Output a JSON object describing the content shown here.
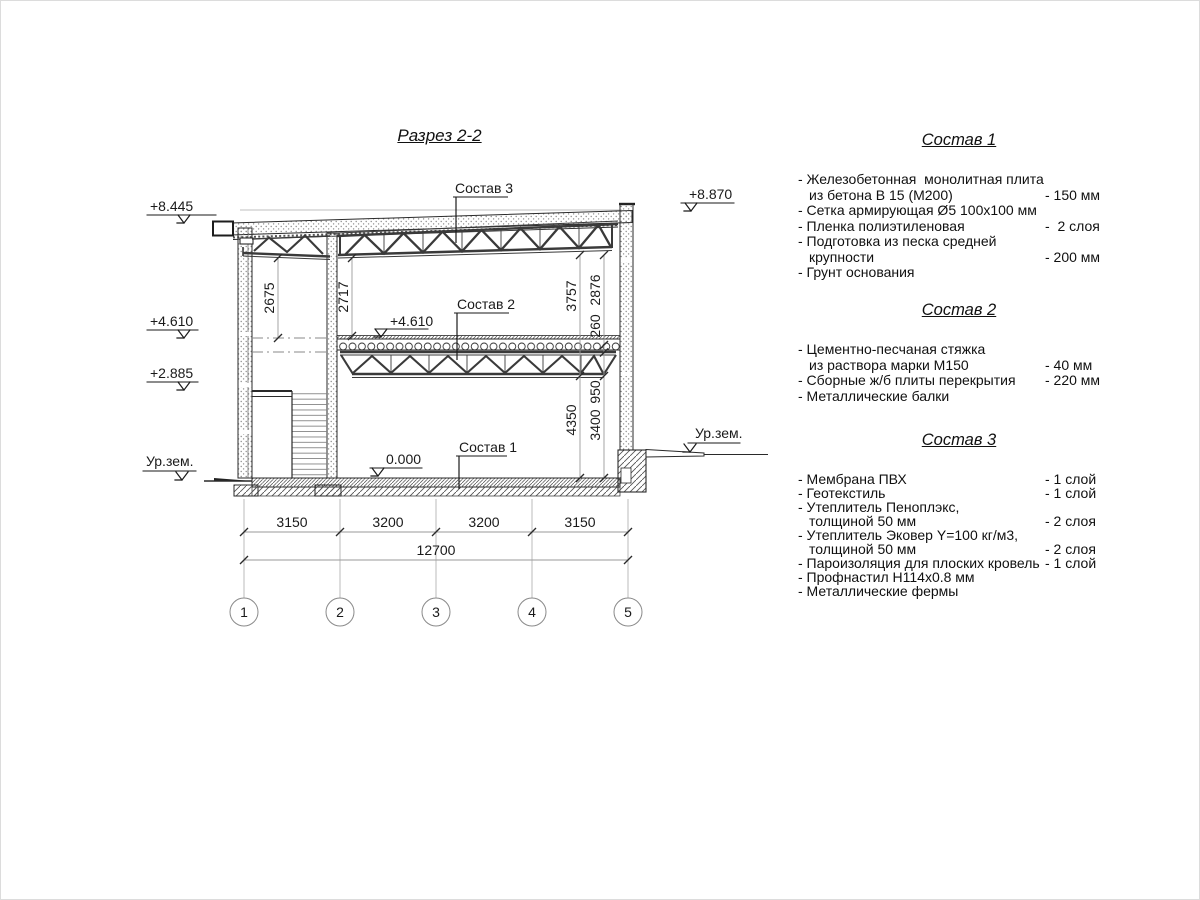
{
  "title": "Разрез 2-2",
  "leaders": {
    "sostav1": "Состав 1",
    "sostav2": "Состав 2",
    "sostav3": "Состав 3"
  },
  "elevations": {
    "roof_left": "+8.445",
    "roof_right": "+8.870",
    "floor2_left": "+4.610",
    "floor2_inner": "+4.610",
    "landing": "+2.885",
    "zero": "0.000",
    "ground_left": "Ур.зем.",
    "ground_right": "Ур.зем."
  },
  "dims": {
    "v2675": "2675",
    "v2717": "2717",
    "v3757": "3757",
    "v2876": "2876",
    "v260": "260",
    "v950": "950",
    "v4350": "4350",
    "v3400": "3400",
    "h1": "3150",
    "h2": "3200",
    "h3": "3200",
    "h4": "3150",
    "total": "12700"
  },
  "axes": [
    "1",
    "2",
    "3",
    "4",
    "5"
  ],
  "compositions": [
    {
      "title": "Состав 1",
      "items": [
        {
          "text": "- Железобетонная  монолитная плита",
          "value": ""
        },
        {
          "text": "из бетона В 15 (М200)",
          "value": "- 150 мм"
        },
        {
          "text": "- Сетка армирующая Ø5 100x100 мм",
          "value": ""
        },
        {
          "text": "- Пленка полиэтиленовая",
          "value": "-  2 слоя"
        },
        {
          "text": "- Подготовка из песка средней",
          "value": ""
        },
        {
          "text": "крупности",
          "value": "- 200 мм"
        },
        {
          "text": "- Грунт основания",
          "value": ""
        }
      ]
    },
    {
      "title": "Состав 2",
      "items": [
        {
          "text": "- Цементно-песчаная стяжка",
          "value": ""
        },
        {
          "text": "из раствора марки М150",
          "value": "- 40 мм"
        },
        {
          "text": "- Сборные ж/б плиты перекрытия",
          "value": "- 220 мм"
        },
        {
          "text": "- Металлические балки",
          "value": ""
        }
      ]
    },
    {
      "title": "Состав 3",
      "items": [
        {
          "text": "- Мембрана ПВХ",
          "value": "- 1 слой"
        },
        {
          "text": "- Геотекстиль",
          "value": "- 1 слой"
        },
        {
          "text": "- Утеплитель Пеноплэкс,",
          "value": ""
        },
        {
          "text": "толщиной 50 мм",
          "value": "- 2 слоя"
        },
        {
          "text": "- Утеплитель Эковер Y=100 кг/м3,",
          "value": ""
        },
        {
          "text": "толщиной 50 мм",
          "value": "- 2 слоя"
        },
        {
          "text": "- Пароизоляция для плоских кровель",
          "value": "- 1 слой"
        },
        {
          "text": "- Профнастил Н114х0.8 мм",
          "value": ""
        },
        {
          "text": "- Металлические фермы",
          "value": ""
        }
      ]
    }
  ]
}
